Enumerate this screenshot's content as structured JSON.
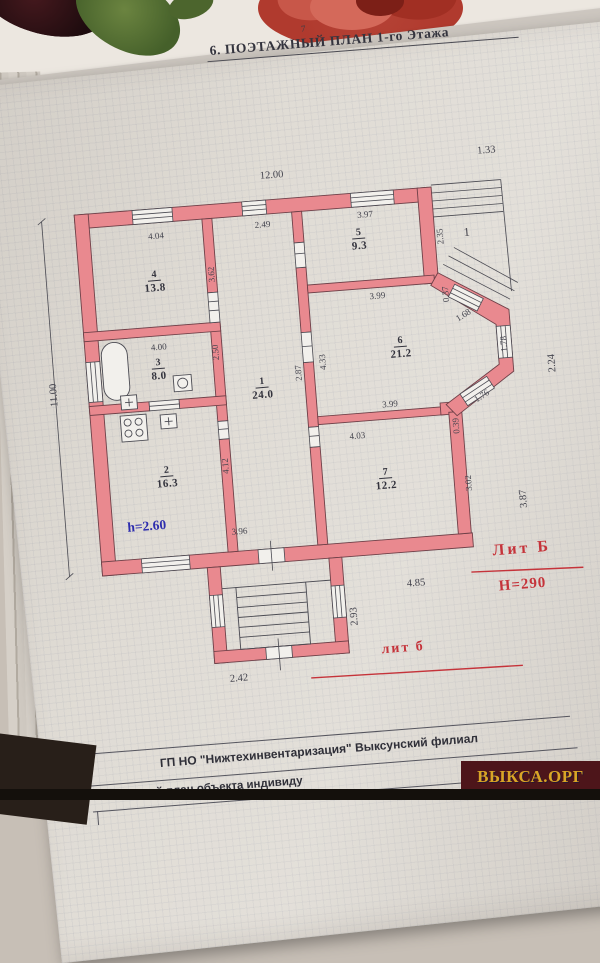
{
  "header": {
    "page_number": "7",
    "title": "6. ПОЭТАЖНЫЙ  ПЛАН  1-го Этажа"
  },
  "plan": {
    "rooms": [
      {
        "number": "1",
        "area": "24.0"
      },
      {
        "number": "2",
        "area": "16.3"
      },
      {
        "number": "3",
        "area": "8.0"
      },
      {
        "number": "4",
        "area": "13.8"
      },
      {
        "number": "5",
        "area": "9.3"
      },
      {
        "number": "6",
        "area": "21.2"
      },
      {
        "number": "7",
        "area": "12.2"
      }
    ],
    "porch_label": "1",
    "marks": {
      "lit_main": "Лит Б",
      "height_mark": "Н=290",
      "lit_porch": "лит б",
      "ceiling_height": "h=2.60"
    },
    "outer_dims": {
      "top": "12.00",
      "top_right": "1.33",
      "left": "11.00",
      "right_upper": "2.24",
      "right_lower": "3.87",
      "bottom_right": "4.85",
      "porch_depth": "2.93",
      "porch_width": "2.42"
    },
    "inner_dims": {
      "r4_width": "4.04",
      "hall_width": "2.49",
      "r5_width": "3.97",
      "r5_height": "2.35",
      "r4_height": "3.62",
      "r3_width": "4.00",
      "r3_height": "2.50",
      "r1_height_a": "2.87",
      "r1_height_b": "4.33",
      "r6_width_top": "3.99",
      "bay_offset_top": "0.37",
      "bay_window_top": "1.68",
      "bay_window_side": "1.78",
      "bay_window_bottom": "1.76",
      "r6_width_bottom": "3.99",
      "bay_offset_bottom": "0.39",
      "r7_width": "4.03",
      "r7_height": "3.02",
      "r2_height": "4.12",
      "r2_width": "3.96"
    }
  },
  "footer": {
    "org_line": "ГП НО \"Нижтехинвентаризация\"  Выксунский филиал",
    "doc_line": "Поэтажный план объекта индивиду",
    "watermark": "ВЫКСА.ОРГ"
  }
}
